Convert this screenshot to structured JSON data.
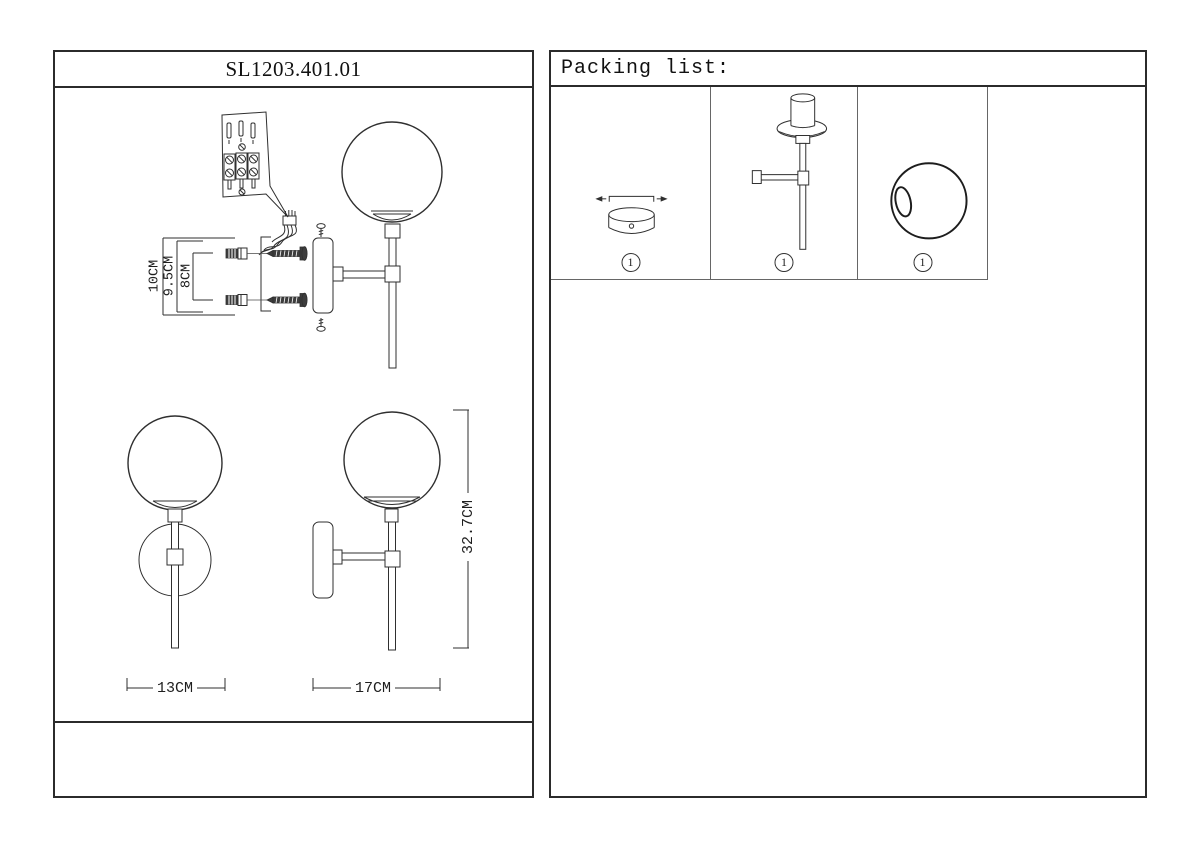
{
  "left_panel": {
    "title": "SL1203.401.01",
    "dims": {
      "mount_total_height": "10CM",
      "mount_mid_height": "9.5CM",
      "mount_hole_spacing": "8CM",
      "front_width": "13CM",
      "side_depth": "17CM",
      "total_height": "32.7CM"
    }
  },
  "right_panel": {
    "title": "Packing list:",
    "items": [
      {
        "qty": "1"
      },
      {
        "qty": "1"
      },
      {
        "qty": "1"
      }
    ]
  }
}
